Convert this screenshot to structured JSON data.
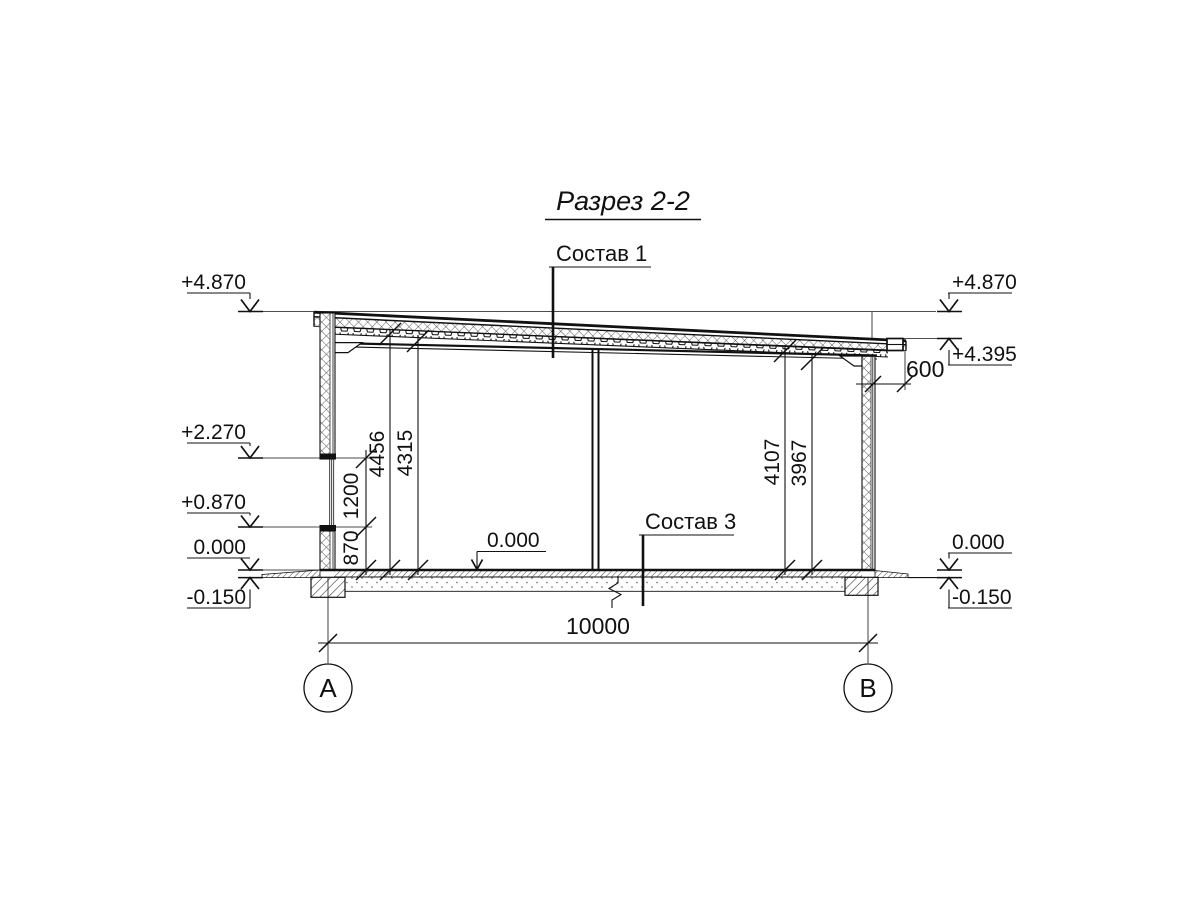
{
  "title": "Разрез 2-2",
  "callouts": {
    "c1": "Состав 1",
    "c3": "Состав 3"
  },
  "levels": {
    "left": [
      "+4.870",
      "+2.270",
      "+0.870",
      "0.000",
      "-0.150"
    ],
    "right": [
      "+4.870",
      "+4.395",
      "0.000",
      "-0.150"
    ],
    "interior": "0.000"
  },
  "dims": {
    "overall": "10000",
    "overhang": "600",
    "window_chain": [
      "870",
      "1200"
    ],
    "left_heights": [
      "4456",
      "4315"
    ],
    "right_heights": [
      "4107",
      "3967"
    ]
  },
  "axes": {
    "a": "А",
    "b": "В"
  }
}
